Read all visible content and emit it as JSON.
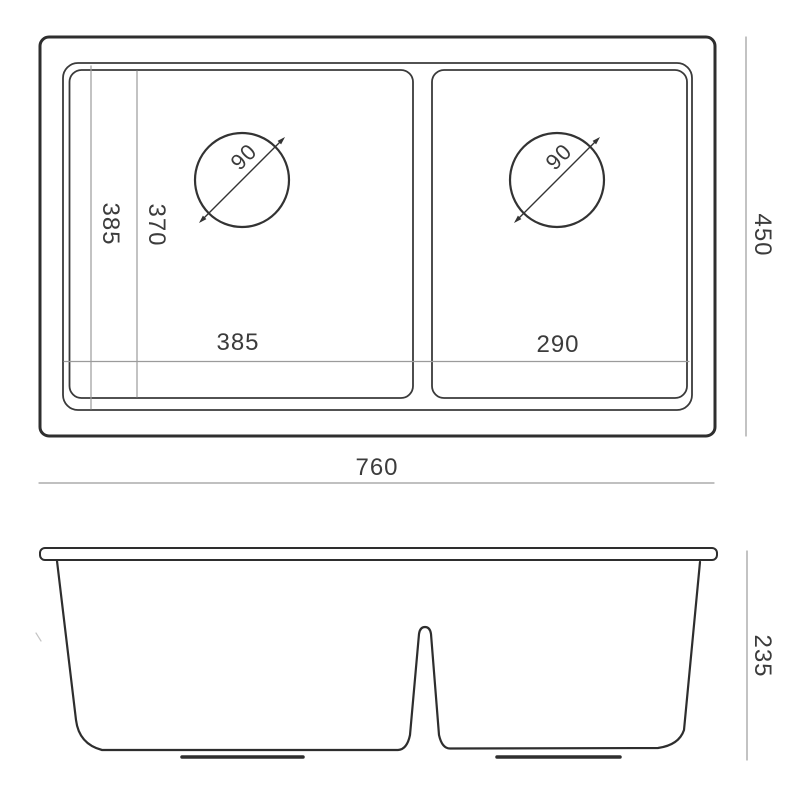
{
  "drawing": {
    "background_color": "#ffffff",
    "outline_color": "#2e2e2e",
    "dim_line_color": "#9b9b9b",
    "text_color": "#3c3c3c",
    "top_view": {
      "overall_width": "760",
      "overall_depth": "450",
      "left_bowl_width": "385",
      "right_bowl_width": "290",
      "rim_depth": "385",
      "bowl_depth": "370",
      "left_drain_diameter": "90",
      "right_drain_diameter": "90"
    },
    "front_view": {
      "overall_height": "235"
    }
  }
}
